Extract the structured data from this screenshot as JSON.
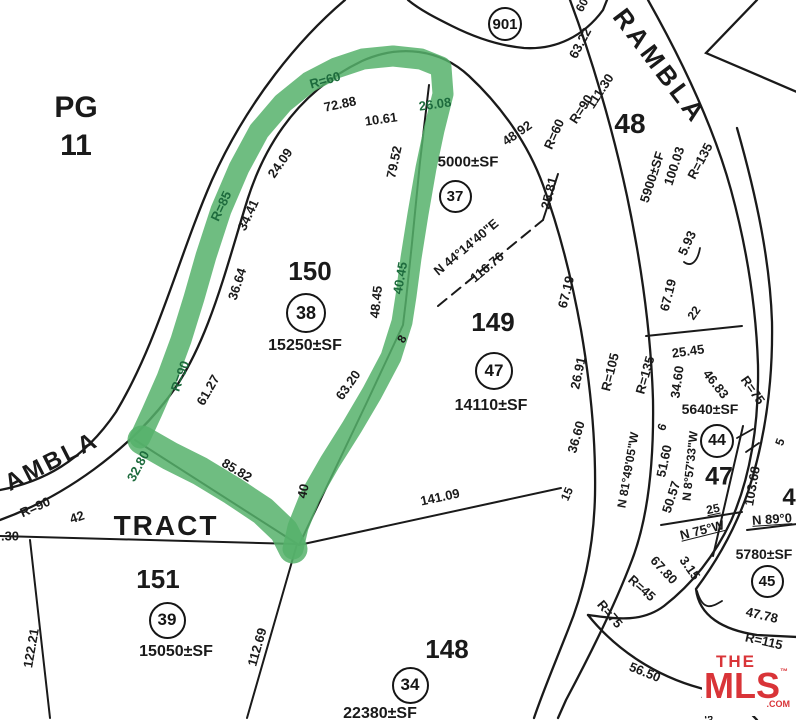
{
  "colors": {
    "line": "#1a1a1a",
    "highlight": "#56b26b",
    "label_on_highlight": "#1d6b3d",
    "logo_red": "#d93438"
  },
  "logo": {
    "the": "THE",
    "mls": "MLS",
    "tm": "™",
    "com": ".COM"
  },
  "map": {
    "page_ref_line1": "PG",
    "page_ref_line2": "11",
    "tract_word": "TRACT",
    "labels": [
      {
        "t": "PG",
        "x": 76,
        "y": 108,
        "s": 30,
        "n": "page-ref"
      },
      {
        "t": "11",
        "x": 76,
        "y": 146,
        "s": 30,
        "n": "page-ref"
      },
      {
        "t": "TRACT",
        "x": 166,
        "y": 526,
        "s": 28,
        "ls": 2,
        "n": "tract-word"
      },
      {
        "t": "AMBLA",
        "x": 52,
        "y": 462,
        "r": -27,
        "s": 24,
        "ls": 3,
        "n": "street-name"
      },
      {
        "t": "RAMBLA",
        "x": 660,
        "y": 66,
        "r": 53,
        "s": 26,
        "ls": 4,
        "n": "street-name"
      },
      {
        "t": "48",
        "x": 630,
        "y": 124,
        "s": 28,
        "n": "lot-number"
      },
      {
        "t": "150",
        "x": 310,
        "y": 271,
        "s": 26,
        "n": "lot-number"
      },
      {
        "t": "15250±SF",
        "x": 305,
        "y": 346,
        "s": 16,
        "n": "lot-area"
      },
      {
        "t": "149",
        "x": 493,
        "y": 322,
        "s": 26,
        "n": "lot-number"
      },
      {
        "t": "14110±SF",
        "x": 491,
        "y": 406,
        "s": 16,
        "n": "lot-area"
      },
      {
        "t": "5000±SF",
        "x": 468,
        "y": 162,
        "s": 15,
        "n": "lot-area"
      },
      {
        "t": "151",
        "x": 158,
        "y": 579,
        "s": 26,
        "n": "lot-number"
      },
      {
        "t": "15050±SF",
        "x": 176,
        "y": 652,
        "s": 16,
        "n": "lot-area"
      },
      {
        "t": "148",
        "x": 447,
        "y": 649,
        "s": 26,
        "n": "lot-number"
      },
      {
        "t": "22380±SF",
        "x": 380,
        "y": 714,
        "s": 16,
        "n": "lot-area"
      },
      {
        "t": "5900±SF",
        "x": 652,
        "y": 177,
        "r": -72,
        "n": "lot-area"
      },
      {
        "t": "100.03",
        "x": 674,
        "y": 166,
        "r": -72,
        "n": "dimension"
      },
      {
        "t": "R=135",
        "x": 700,
        "y": 161,
        "r": -62,
        "n": "radius"
      },
      {
        "t": "5640±SF",
        "x": 710,
        "y": 409,
        "s": 14,
        "n": "lot-area"
      },
      {
        "t": "5780±SF",
        "x": 764,
        "y": 554,
        "s": 14,
        "n": "lot-area"
      },
      {
        "t": "47",
        "x": 719,
        "y": 477,
        "s": 25,
        "n": "lot-number"
      },
      {
        "t": "4",
        "x": 789,
        "y": 498,
        "s": 24,
        "n": "lot-number-partial"
      },
      {
        "t": "R=60",
        "x": 325,
        "y": 80,
        "r": -16,
        "c": "g",
        "n": "radius"
      },
      {
        "t": "R=85",
        "x": 221,
        "y": 206,
        "r": -65,
        "c": "g",
        "n": "radius"
      },
      {
        "t": "R=90",
        "x": 180,
        "y": 376,
        "r": -70,
        "c": "g",
        "n": "radius"
      },
      {
        "t": "32.80",
        "x": 138,
        "y": 466,
        "r": -62,
        "c": "g",
        "n": "dimension"
      },
      {
        "t": "26.08",
        "x": 435,
        "y": 104,
        "r": -8,
        "c": "g",
        "n": "dimension"
      },
      {
        "t": "40.45",
        "x": 400,
        "y": 278,
        "r": -80,
        "c": "g",
        "n": "dimension"
      },
      {
        "t": "72.88",
        "x": 340,
        "y": 104,
        "r": -12,
        "n": "dimension"
      },
      {
        "t": "10.61",
        "x": 381,
        "y": 119,
        "r": -8,
        "n": "dimension"
      },
      {
        "t": "24.09",
        "x": 280,
        "y": 163,
        "r": -55,
        "n": "dimension"
      },
      {
        "t": "34.41",
        "x": 248,
        "y": 215,
        "r": -65,
        "n": "dimension"
      },
      {
        "t": "36.64",
        "x": 237,
        "y": 284,
        "r": -72,
        "n": "dimension"
      },
      {
        "t": "61.27",
        "x": 208,
        "y": 390,
        "r": -60,
        "n": "dimension"
      },
      {
        "t": "79.52",
        "x": 394,
        "y": 162,
        "r": -78,
        "n": "dimension"
      },
      {
        "t": "48.45",
        "x": 376,
        "y": 302,
        "r": -84,
        "n": "dimension"
      },
      {
        "t": "8",
        "x": 402,
        "y": 339,
        "r": -60,
        "s": 12,
        "n": "dimension"
      },
      {
        "t": "63.20",
        "x": 348,
        "y": 385,
        "r": -55,
        "n": "dimension"
      },
      {
        "t": "85.82",
        "x": 237,
        "y": 470,
        "r": 31,
        "n": "dimension"
      },
      {
        "t": "40",
        "x": 303,
        "y": 491,
        "r": -78,
        "n": "dimension"
      },
      {
        "t": "48.92",
        "x": 517,
        "y": 133,
        "r": -35,
        "n": "dimension"
      },
      {
        "t": "R=60",
        "x": 554,
        "y": 134,
        "r": -66,
        "n": "radius"
      },
      {
        "t": "25.81",
        "x": 549,
        "y": 193,
        "r": -76,
        "n": "dimension"
      },
      {
        "t": "N 44°14'40\"E",
        "x": 466,
        "y": 247,
        "r": -40,
        "n": "bearing"
      },
      {
        "t": "116.76",
        "x": 487,
        "y": 267,
        "r": -40,
        "n": "dimension"
      },
      {
        "t": "63.22",
        "x": 580,
        "y": 43,
        "r": -62,
        "n": "dimension"
      },
      {
        "t": "111.30",
        "x": 600,
        "y": 91,
        "r": -57,
        "n": "dimension"
      },
      {
        "t": "R=90",
        "x": 581,
        "y": 109,
        "r": -57,
        "n": "radius"
      },
      {
        "t": "R=90",
        "x": 35,
        "y": 507,
        "r": -24,
        "n": "radius"
      },
      {
        "t": "42",
        "x": 77,
        "y": 517,
        "r": -18,
        "n": "dimension"
      },
      {
        "t": ".30",
        "x": 10,
        "y": 536,
        "n": "dimension-partial"
      },
      {
        "t": "122.21",
        "x": 31,
        "y": 648,
        "r": -80,
        "n": "dimension"
      },
      {
        "t": "112.69",
        "x": 257,
        "y": 647,
        "r": -74,
        "n": "dimension"
      },
      {
        "t": "141.09",
        "x": 440,
        "y": 497,
        "r": -12,
        "n": "dimension"
      },
      {
        "t": "67.19",
        "x": 566,
        "y": 292,
        "r": -76,
        "n": "dimension"
      },
      {
        "t": "26.91",
        "x": 578,
        "y": 373,
        "r": -78,
        "n": "dimension"
      },
      {
        "t": "36.60",
        "x": 576,
        "y": 437,
        "r": -74,
        "n": "dimension"
      },
      {
        "t": "15",
        "x": 567,
        "y": 494,
        "r": -66,
        "s": 12,
        "n": "dimension"
      },
      {
        "t": "R=105",
        "x": 610,
        "y": 372,
        "r": -76,
        "n": "radius"
      },
      {
        "t": "R=135",
        "x": 645,
        "y": 375,
        "r": -74,
        "n": "radius"
      },
      {
        "t": "67.19",
        "x": 668,
        "y": 295,
        "r": -76,
        "n": "dimension"
      },
      {
        "t": "5.93",
        "x": 687,
        "y": 243,
        "r": -65,
        "n": "dimension"
      },
      {
        "t": "22",
        "x": 694,
        "y": 313,
        "r": -55,
        "s": 12,
        "n": "dimension"
      },
      {
        "t": "25.45",
        "x": 688,
        "y": 351,
        "r": -8,
        "n": "dimension"
      },
      {
        "t": "34.60",
        "x": 677,
        "y": 382,
        "r": -82,
        "n": "dimension"
      },
      {
        "t": "46.83",
        "x": 716,
        "y": 384,
        "r": 52,
        "n": "dimension"
      },
      {
        "t": "R=75",
        "x": 753,
        "y": 390,
        "r": 55,
        "n": "radius"
      },
      {
        "t": "N 81°49'05\"W",
        "x": 628,
        "y": 470,
        "r": -80,
        "s": 12,
        "n": "bearing"
      },
      {
        "t": "6",
        "x": 662,
        "y": 427,
        "r": -70,
        "s": 12,
        "n": "dimension"
      },
      {
        "t": "51.60",
        "x": 664,
        "y": 461,
        "r": -78,
        "n": "dimension"
      },
      {
        "t": "50.57",
        "x": 671,
        "y": 497,
        "r": -72,
        "n": "dimension"
      },
      {
        "t": "N 8°57'33\"W",
        "x": 690,
        "y": 466,
        "r": -84,
        "s": 12,
        "n": "bearing"
      },
      {
        "t": "103.68",
        "x": 752,
        "y": 486,
        "r": -80,
        "n": "dimension"
      },
      {
        "t": "25",
        "x": 713,
        "y": 509,
        "r": -12,
        "s": 12,
        "u": 1,
        "n": "dimension"
      },
      {
        "t": "N 75°W",
        "x": 702,
        "y": 530,
        "r": -14,
        "u": 1,
        "n": "bearing"
      },
      {
        "t": "N 89°0",
        "x": 772,
        "y": 519,
        "r": -4,
        "u": 1,
        "n": "bearing-partial"
      },
      {
        "t": "3.15",
        "x": 690,
        "y": 568,
        "r": 55,
        "n": "dimension"
      },
      {
        "t": "67.80",
        "x": 664,
        "y": 570,
        "r": 47,
        "n": "dimension"
      },
      {
        "t": "R=45",
        "x": 642,
        "y": 588,
        "r": 42,
        "n": "radius"
      },
      {
        "t": "R=75",
        "x": 610,
        "y": 614,
        "r": 50,
        "n": "radius"
      },
      {
        "t": "47.78",
        "x": 762,
        "y": 615,
        "r": 13,
        "n": "dimension"
      },
      {
        "t": "R=115",
        "x": 764,
        "y": 641,
        "r": 13,
        "n": "radius"
      },
      {
        "t": "56.50",
        "x": 645,
        "y": 672,
        "r": 22,
        "n": "dimension"
      },
      {
        "t": "5.5",
        "x": 709,
        "y": 694,
        "r": -62,
        "s": 11,
        "n": "dimension-partial"
      },
      {
        "t": "3.2",
        "x": 712,
        "y": 714,
        "r": -62,
        "s": 11,
        "n": "dimension-partial"
      },
      {
        "t": "60",
        "x": 582,
        "y": 5,
        "r": -62,
        "s": 12,
        "n": "dimension-partial"
      },
      {
        "t": "5",
        "x": 780,
        "y": 442,
        "r": -70,
        "s": 12,
        "n": "dimension-partial"
      }
    ],
    "circled_lots": [
      {
        "n": "901",
        "x": 505,
        "y": 24,
        "d": 34,
        "s": 15
      },
      {
        "n": "38",
        "x": 306,
        "y": 313,
        "d": 40,
        "s": 18
      },
      {
        "n": "37",
        "x": 455,
        "y": 196,
        "d": 33,
        "s": 15
      },
      {
        "n": "47",
        "x": 494,
        "y": 371,
        "d": 38,
        "s": 17
      },
      {
        "n": "39",
        "x": 167,
        "y": 620,
        "d": 37,
        "s": 17
      },
      {
        "n": "34",
        "x": 410,
        "y": 685,
        "d": 37,
        "s": 17
      },
      {
        "n": "44",
        "x": 717,
        "y": 441,
        "d": 34,
        "s": 16
      },
      {
        "n": "45",
        "x": 767,
        "y": 581,
        "d": 33,
        "s": 15
      }
    ]
  }
}
